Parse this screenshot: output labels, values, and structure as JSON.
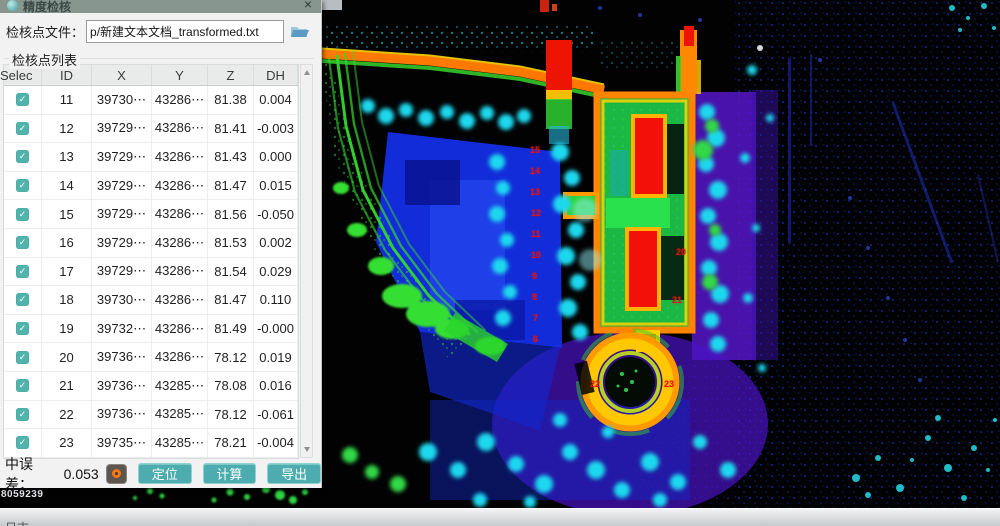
{
  "window": {
    "title": "精度检核",
    "close_glyph": "×"
  },
  "file_row": {
    "label": "检核点文件：",
    "value": "p/新建文本文档_transformed.txt"
  },
  "list_label": "检核点列表",
  "table": {
    "headers": [
      "Selec",
      "ID",
      "X",
      "Y",
      "Z",
      "DH"
    ],
    "checkbox_glyph": "✓",
    "rows": [
      {
        "checked": true,
        "id": "11",
        "x": "39730⋯",
        "y": "43286⋯",
        "z": "81.38",
        "dh": "0.004"
      },
      {
        "checked": true,
        "id": "12",
        "x": "39729⋯",
        "y": "43286⋯",
        "z": "81.41",
        "dh": "-0.003"
      },
      {
        "checked": true,
        "id": "13",
        "x": "39729⋯",
        "y": "43286⋯",
        "z": "81.43",
        "dh": "0.000"
      },
      {
        "checked": true,
        "id": "14",
        "x": "39729⋯",
        "y": "43286⋯",
        "z": "81.47",
        "dh": "0.015"
      },
      {
        "checked": true,
        "id": "15",
        "x": "39729⋯",
        "y": "43286⋯",
        "z": "81.56",
        "dh": "-0.050"
      },
      {
        "checked": true,
        "id": "16",
        "x": "39729⋯",
        "y": "43286⋯",
        "z": "81.53",
        "dh": "0.002"
      },
      {
        "checked": true,
        "id": "17",
        "x": "39729⋯",
        "y": "43286⋯",
        "z": "81.54",
        "dh": "0.029"
      },
      {
        "checked": true,
        "id": "18",
        "x": "39730⋯",
        "y": "43286⋯",
        "z": "81.47",
        "dh": "0.110"
      },
      {
        "checked": true,
        "id": "19",
        "x": "39732⋯",
        "y": "43286⋯",
        "z": "81.49",
        "dh": "-0.000"
      },
      {
        "checked": true,
        "id": "20",
        "x": "39736⋯",
        "y": "43286⋯",
        "z": "78.12",
        "dh": "0.019"
      },
      {
        "checked": true,
        "id": "21",
        "x": "39736⋯",
        "y": "43285⋯",
        "z": "78.08",
        "dh": "0.016"
      },
      {
        "checked": true,
        "id": "22",
        "x": "39736⋯",
        "y": "43285⋯",
        "z": "78.12",
        "dh": "-0.061"
      },
      {
        "checked": true,
        "id": "23",
        "x": "39735⋯",
        "y": "43285⋯",
        "z": "78.21",
        "dh": "-0.004"
      }
    ]
  },
  "footer": {
    "rmse_label": "中误差：",
    "rmse_value": "0.053",
    "buttons": [
      "定位",
      "计算",
      "导出"
    ]
  },
  "statusbar": {
    "left_text": "日志"
  },
  "pointcloud": {
    "readout": "8059239",
    "labels": [
      {
        "t": "15",
        "x": 530,
        "y": 146
      },
      {
        "t": "14",
        "x": 530,
        "y": 167
      },
      {
        "t": "13",
        "x": 530,
        "y": 188
      },
      {
        "t": "12",
        "x": 531,
        "y": 209
      },
      {
        "t": "11",
        "x": 531,
        "y": 230
      },
      {
        "t": "10",
        "x": 531,
        "y": 251
      },
      {
        "t": "9",
        "x": 532,
        "y": 272
      },
      {
        "t": "8",
        "x": 532,
        "y": 293
      },
      {
        "t": "7",
        "x": 533,
        "y": 314
      },
      {
        "t": "6",
        "x": 533,
        "y": 335
      },
      {
        "t": "20",
        "x": 676,
        "y": 248
      },
      {
        "t": "21",
        "x": 672,
        "y": 296
      },
      {
        "t": "22",
        "x": 590,
        "y": 380
      },
      {
        "t": "23",
        "x": 664,
        "y": 380
      }
    ]
  },
  "colors": {
    "accent_teal": "#4cacae",
    "checkbox_teal": "#52b3ac",
    "titlebar_green": "#87978f",
    "indicator_orange": "#ff7614",
    "label_red": "#e01212"
  }
}
